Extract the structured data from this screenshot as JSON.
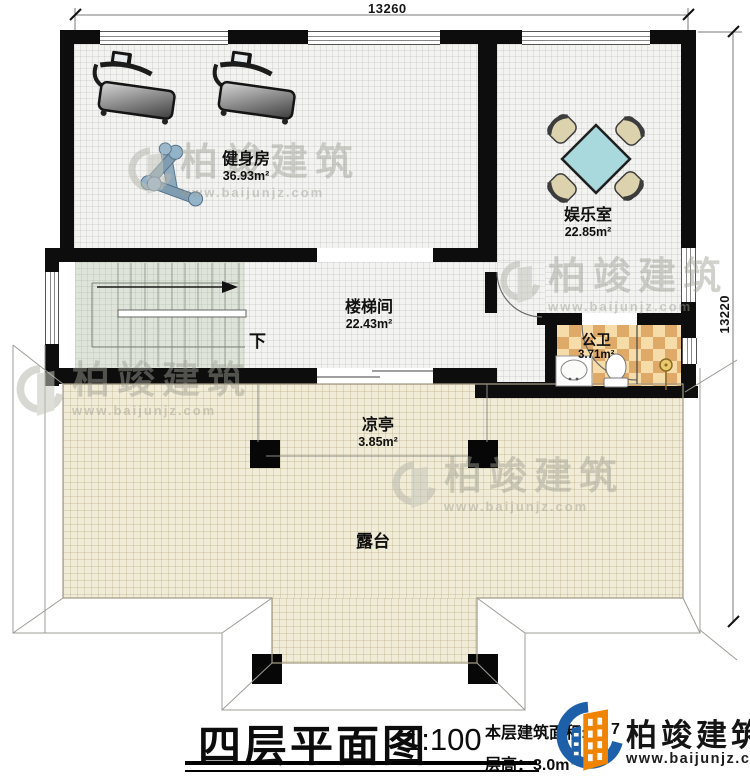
{
  "dimensions": {
    "top": "13260",
    "right": "13220"
  },
  "rooms": {
    "gym": {
      "name": "健身房",
      "area": "36.93m²"
    },
    "recreation": {
      "name": "娱乐室",
      "area": "22.85m²"
    },
    "stairwell": {
      "name": "楼梯间",
      "area": "22.43m²"
    },
    "bathroom": {
      "name": "公卫",
      "area": "3.71m²"
    },
    "pavilion": {
      "name": "凉亭",
      "area": "3.85m²"
    },
    "terrace": {
      "name": "露台"
    },
    "stairs_direction": "下"
  },
  "title_block": {
    "title": "四层平面图",
    "scale": "1:100",
    "area_label": "本层建筑面积:",
    "area_visible_digit": "7",
    "floor_height": "层高：3.0m"
  },
  "logo": {
    "company": "柏竣建筑",
    "website": "www.baijunjz.com"
  },
  "watermark": {
    "company": "柏竣建筑",
    "website": "www.baijunjz.com"
  },
  "colors": {
    "wall": "#0d0d0d",
    "stairs_floor": "#dee4d9",
    "terrace_floor": "#f1ecd7",
    "tile_light": "#f6dca9",
    "tile_dark": "#dfa968",
    "table_teal": "#a9d9dd",
    "chair_tan": "#ddd2ae",
    "logo_blue": "#1d5fa8",
    "logo_orange": "#f08300"
  }
}
